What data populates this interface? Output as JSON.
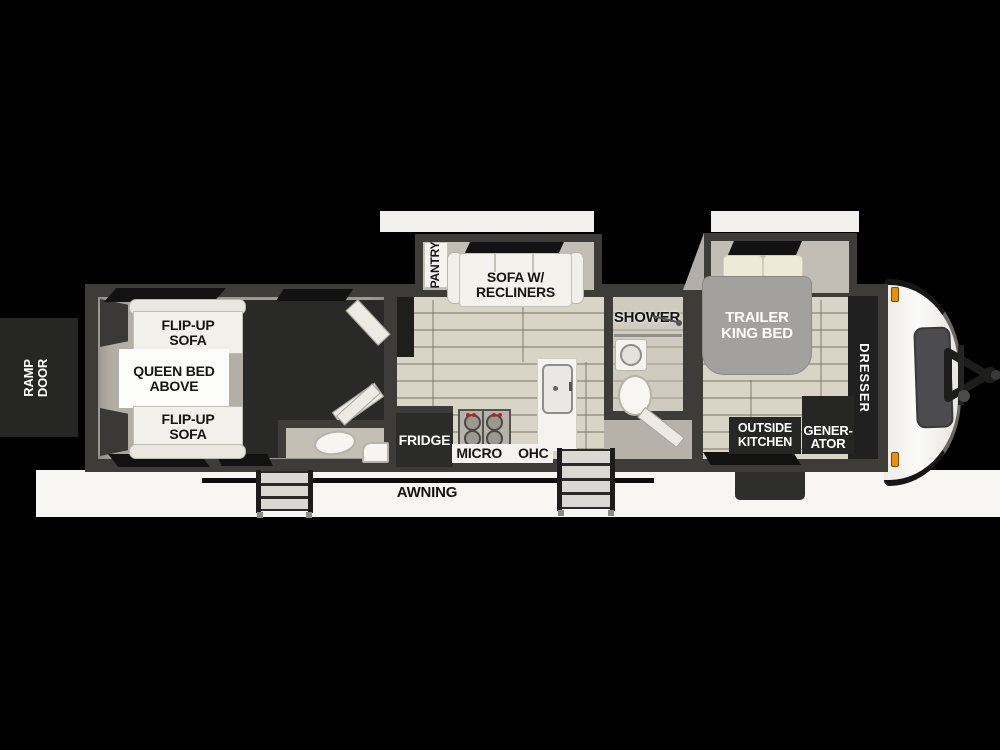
{
  "title": "Toy hauler travel trailer floor plan",
  "palette": {
    "background": "#000000",
    "canvas_white": "#f7f6f3",
    "wall_dark": "#3d3c39",
    "floor_plank": "#d8d4c6",
    "floor_ring": "#b3afa6",
    "garage_dark": "#292927",
    "fixture_white": "#f1f0ea",
    "dark_box": "#262624",
    "bed_gray": "#a2a19d",
    "pillow_cream": "#efe9d8",
    "clearance_light_orange": "#e8900a",
    "window_black": "#121212"
  },
  "labels": {
    "ramp_door": [
      "RAMP",
      "DOOR"
    ],
    "flip_up_sofa_top": [
      "FLIP-UP",
      "SOFA"
    ],
    "queen_bed_above": [
      "QUEEN BED",
      "ABOVE"
    ],
    "flip_up_sofa_bottom": [
      "FLIP-UP",
      "SOFA"
    ],
    "pantry": "PANTRY",
    "sofa_w_recliners": [
      "SOFA W/",
      "RECLINERS"
    ],
    "shower": "SHOWER",
    "trailer_king_bed": [
      "TRAILER",
      "KING BED"
    ],
    "dresser": "DRESSER",
    "fridge": "FRIDGE",
    "micro": "MICRO",
    "ohc": "OHC",
    "outside_kitchen": [
      "OUTSIDE",
      "KITCHEN"
    ],
    "generator": [
      "GENER-",
      "ATOR"
    ],
    "awning": "AWNING"
  }
}
